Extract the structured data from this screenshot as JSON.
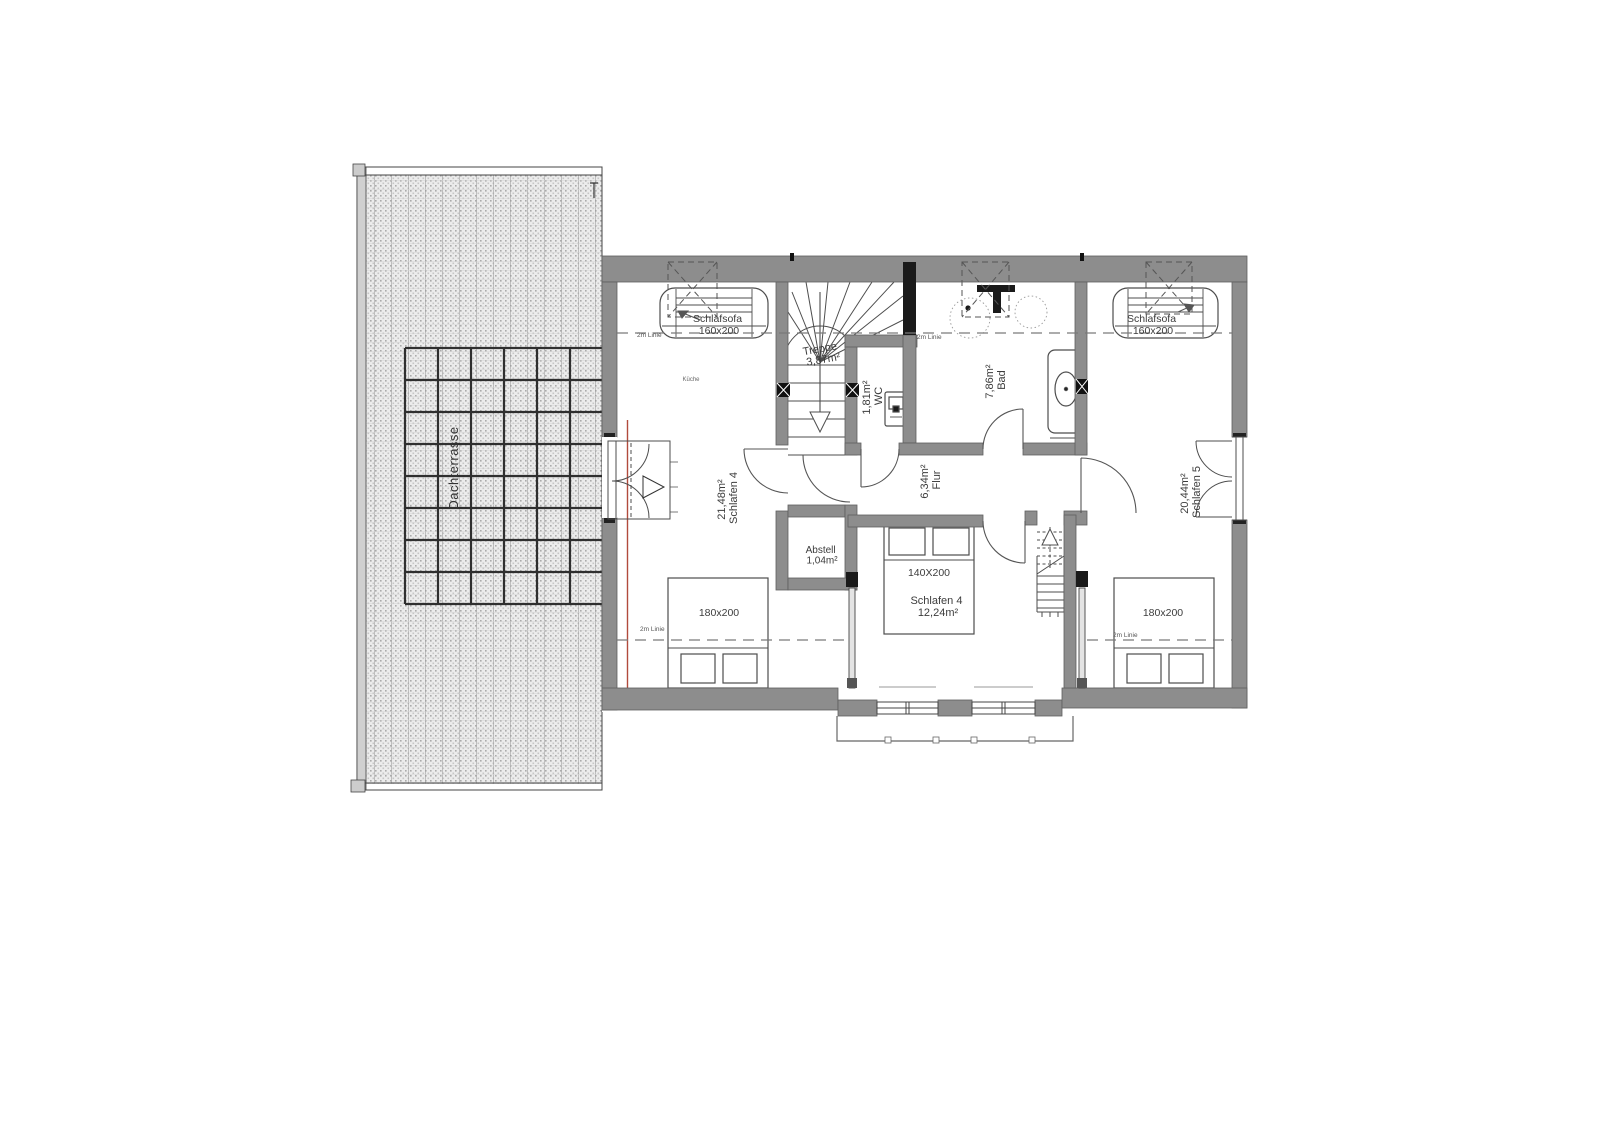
{
  "plan": {
    "terrace": {
      "label": "Dachterrasse"
    },
    "rooms": {
      "bedroom_left": {
        "area": "21,48m²",
        "name": "Schlafen 4"
      },
      "bedroom_center": {
        "name": "Schlafen 4",
        "area": "12,24m²"
      },
      "bedroom_right": {
        "area": "20,44m²",
        "name": "Schlafen 5"
      },
      "hall": {
        "area": "6,34m²",
        "name": "Flur"
      },
      "bath": {
        "area": "7,86m²",
        "name": "Bad"
      },
      "wc": {
        "area": "1,81m²",
        "name": "WC"
      },
      "stair": {
        "name": "Treppe",
        "area": "3,87m²"
      },
      "storage": {
        "name": "Abstell",
        "area": "1,04m²"
      },
      "ghost_label": "Küche"
    },
    "furniture": {
      "sofa_left": {
        "name": "Schlafsofa",
        "size": "160x200"
      },
      "sofa_right": {
        "name": "Schlafsofa",
        "size": "160x200"
      },
      "bed_left": {
        "size": "180x200"
      },
      "bed_center": {
        "size": "140X200"
      },
      "bed_right": {
        "size": "180x200"
      }
    },
    "annotations": {
      "height_line": "2m Linie"
    },
    "colors": {
      "wall": "#8d8d8d",
      "wall_dark": "#1a1a1a",
      "line": "#4d4d4d",
      "dashed_line": "#7a7a7a",
      "accent_red": "#b14b3c",
      "terrace_grid": "#2f2f2f",
      "background": "#ffffff"
    }
  }
}
